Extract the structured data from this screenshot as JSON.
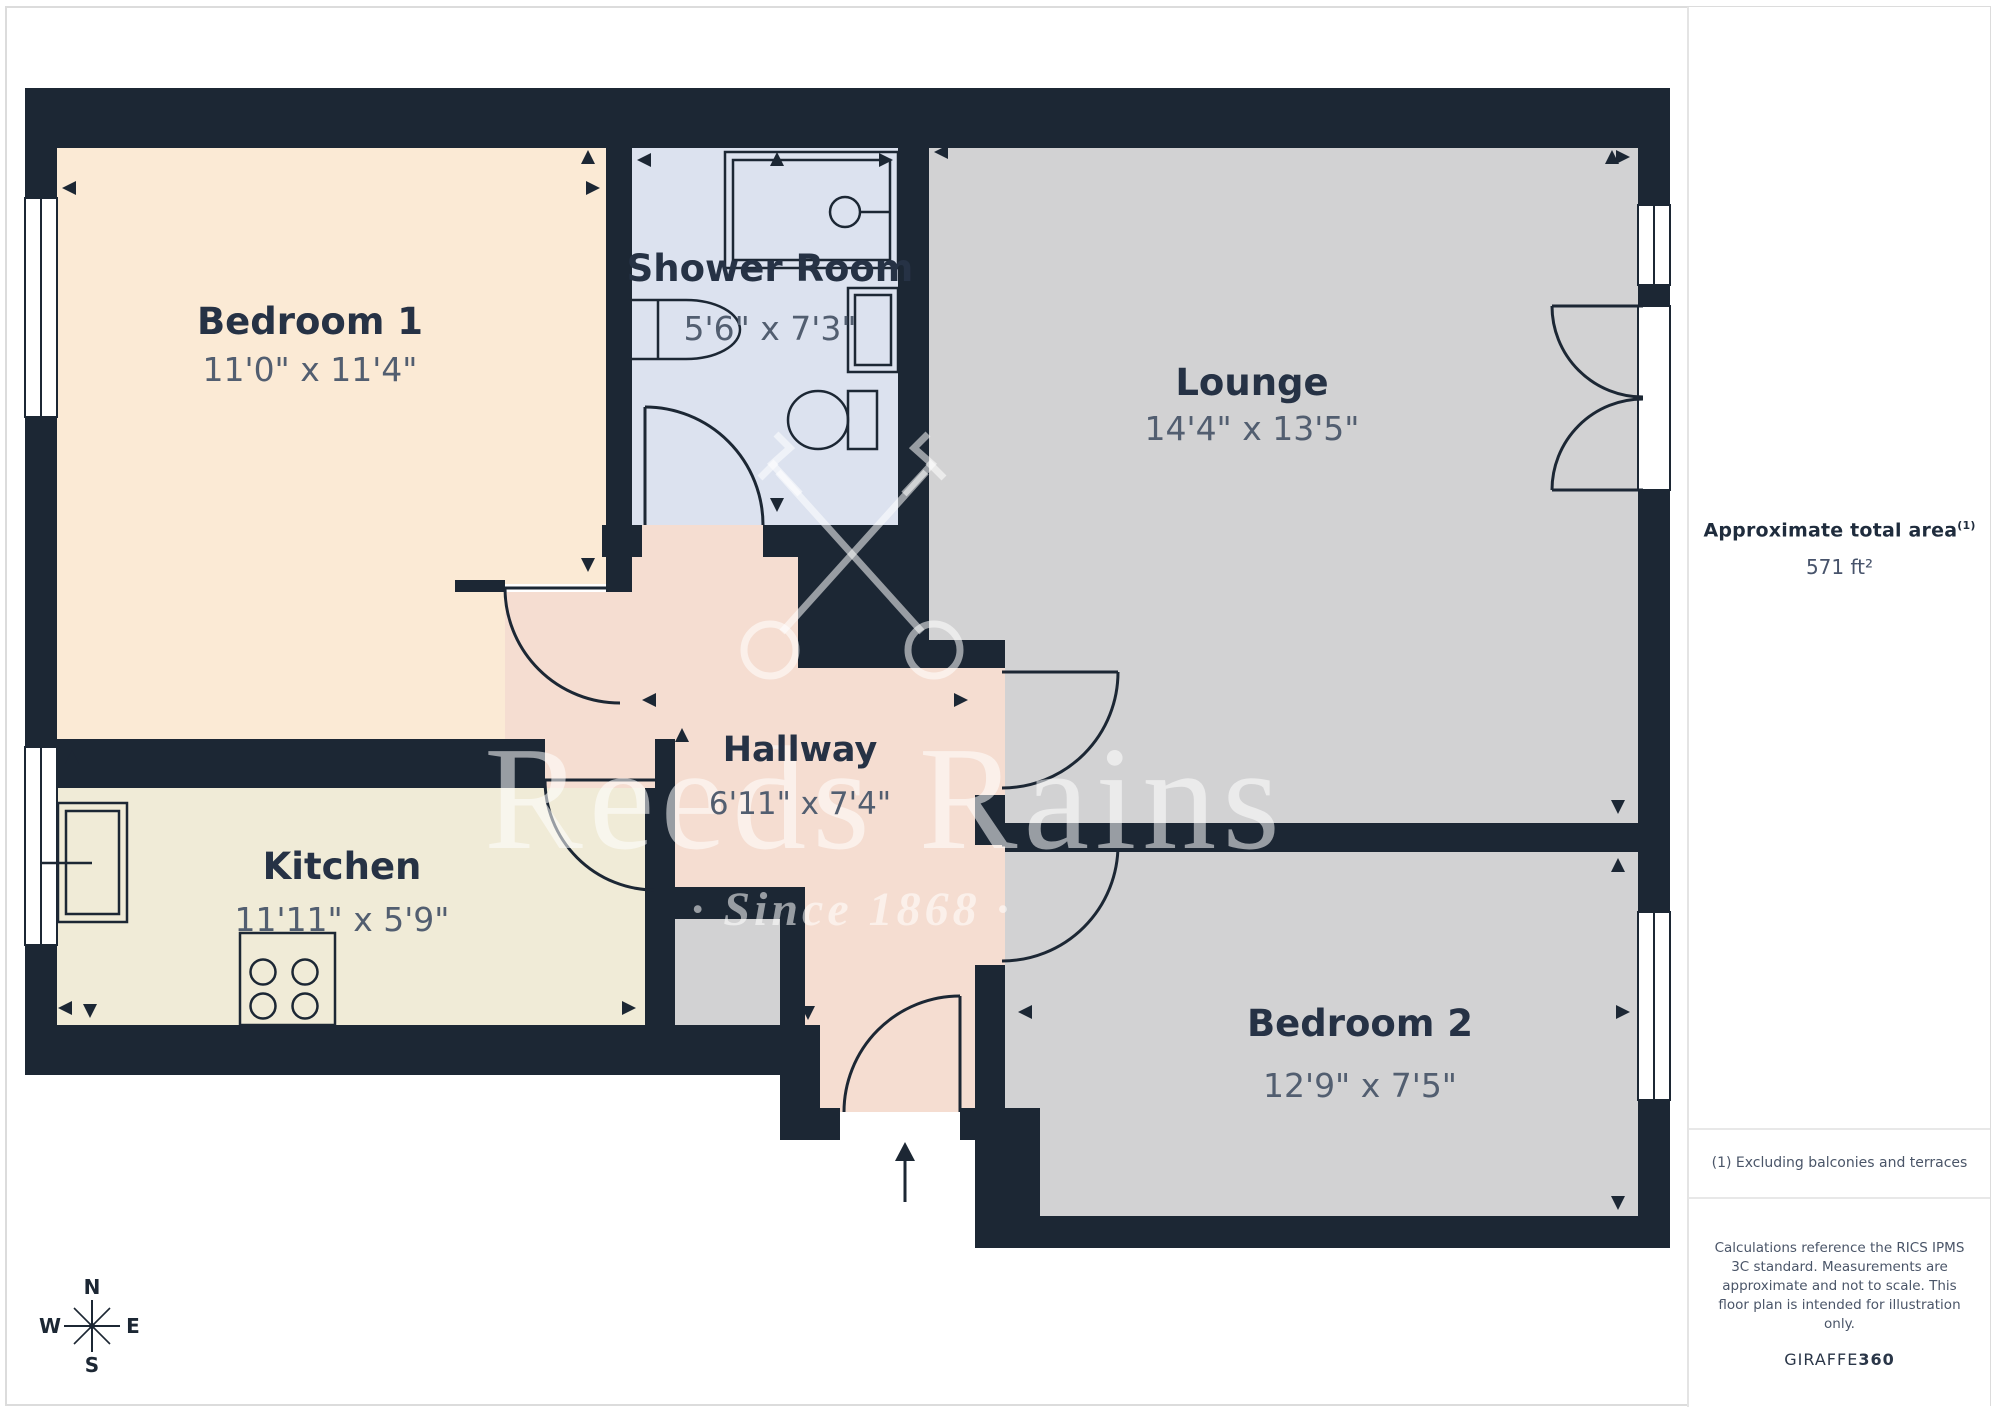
{
  "plan": {
    "wall_color": "#1c2734",
    "rooms": [
      {
        "name": "Bedroom 1",
        "dims": "11'0\" x 11'4\"",
        "color": "#fbead5"
      },
      {
        "name": "Shower Room",
        "dims": "5'6\" x 7'3\"",
        "color": "#dce2ef"
      },
      {
        "name": "Lounge",
        "dims": "14'4\" x 13'5\"",
        "color": "#d2d2d3"
      },
      {
        "name": "Kitchen",
        "dims": "11'11\" x 5'9\"",
        "color": "#f0ebd7"
      },
      {
        "name": "Hallway",
        "dims": "6'11\" x 7'4\"",
        "color": "#f5ddd1"
      },
      {
        "name": "Bedroom 2",
        "dims": "12'9\" x 7'5\"",
        "color": "#d2d2d3"
      }
    ]
  },
  "watermark": {
    "brand": "Reeds Rains",
    "tagline": "· Since 1868 ·"
  },
  "compass": {
    "n": "N",
    "s": "S",
    "e": "E",
    "w": "W"
  },
  "sidebar": {
    "area_title": "Approximate total area",
    "area_superscript": "(1)",
    "area_value": "571 ft²",
    "footnote": "(1) Excluding balconies and terraces",
    "disclaimer_lines": [
      "Calculations reference the RICS IPMS",
      "3C standard. Measurements are",
      "approximate and not to scale. This",
      "floor plan is intended for illustration",
      "only."
    ],
    "brand_left": "GIRAFFE",
    "brand_right": "360"
  }
}
